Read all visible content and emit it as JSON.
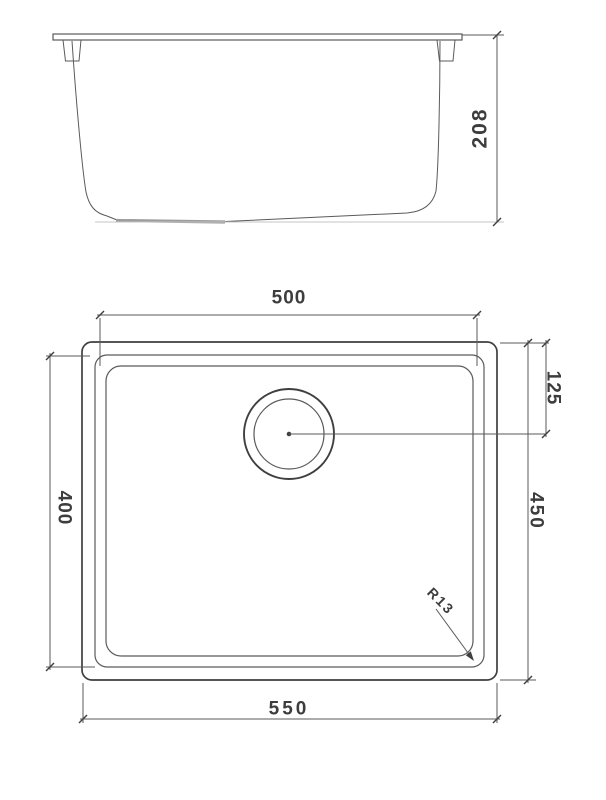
{
  "colors": {
    "background": "#ffffff",
    "line_dark": "#3f3f3f",
    "line_medium": "#5a5a5a",
    "line_light": "#c4c4c4",
    "strip": "#9c9c9c",
    "text": "#3d3d3d"
  },
  "side_view": {
    "description": "sink side elevation",
    "dim_depth": "208"
  },
  "plan_view": {
    "description": "sink top plan",
    "dim_bowl_width": "500",
    "dim_overall_width": "550",
    "dim_bowl_length": "400",
    "dim_overall_length": "450",
    "dim_drain_offset": "125",
    "dim_corner_radius": "R13"
  }
}
